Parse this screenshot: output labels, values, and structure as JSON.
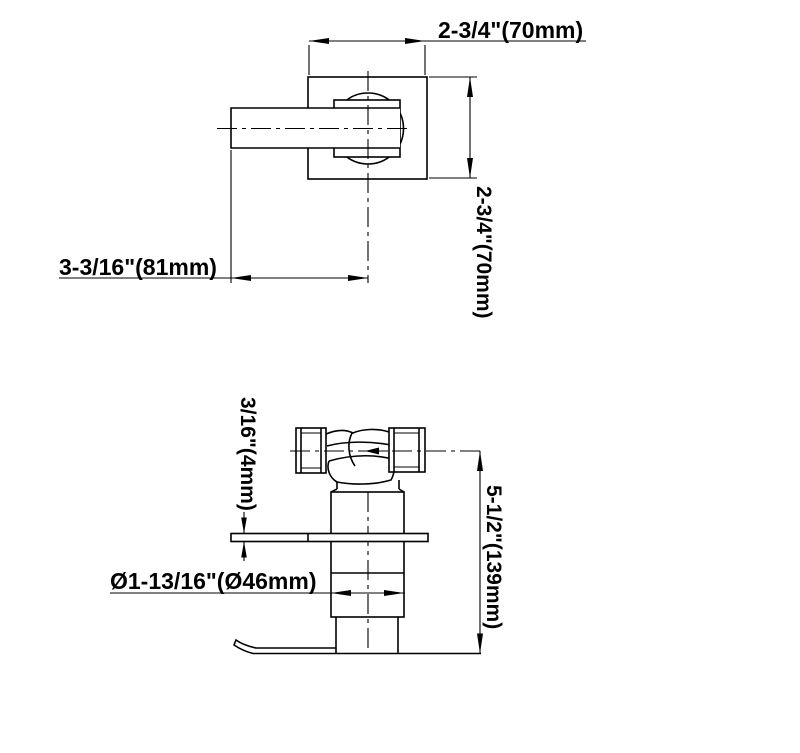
{
  "drawing": {
    "background_color": "#ffffff",
    "line_color": "#000000",
    "top_view": {
      "dim_width_label": "2-3/4\"(70mm)",
      "dim_height_label": "2-3/4\"(70mm)",
      "dim_reach_label": "3-3/16\"(81mm)"
    },
    "side_view": {
      "dim_plate_thickness_label": "3/16\"(4mm)",
      "dim_total_height_label": "5-1/2\"(139mm)",
      "dim_diameter_label": "Ø1-13/16\"(Ø46mm)"
    }
  }
}
